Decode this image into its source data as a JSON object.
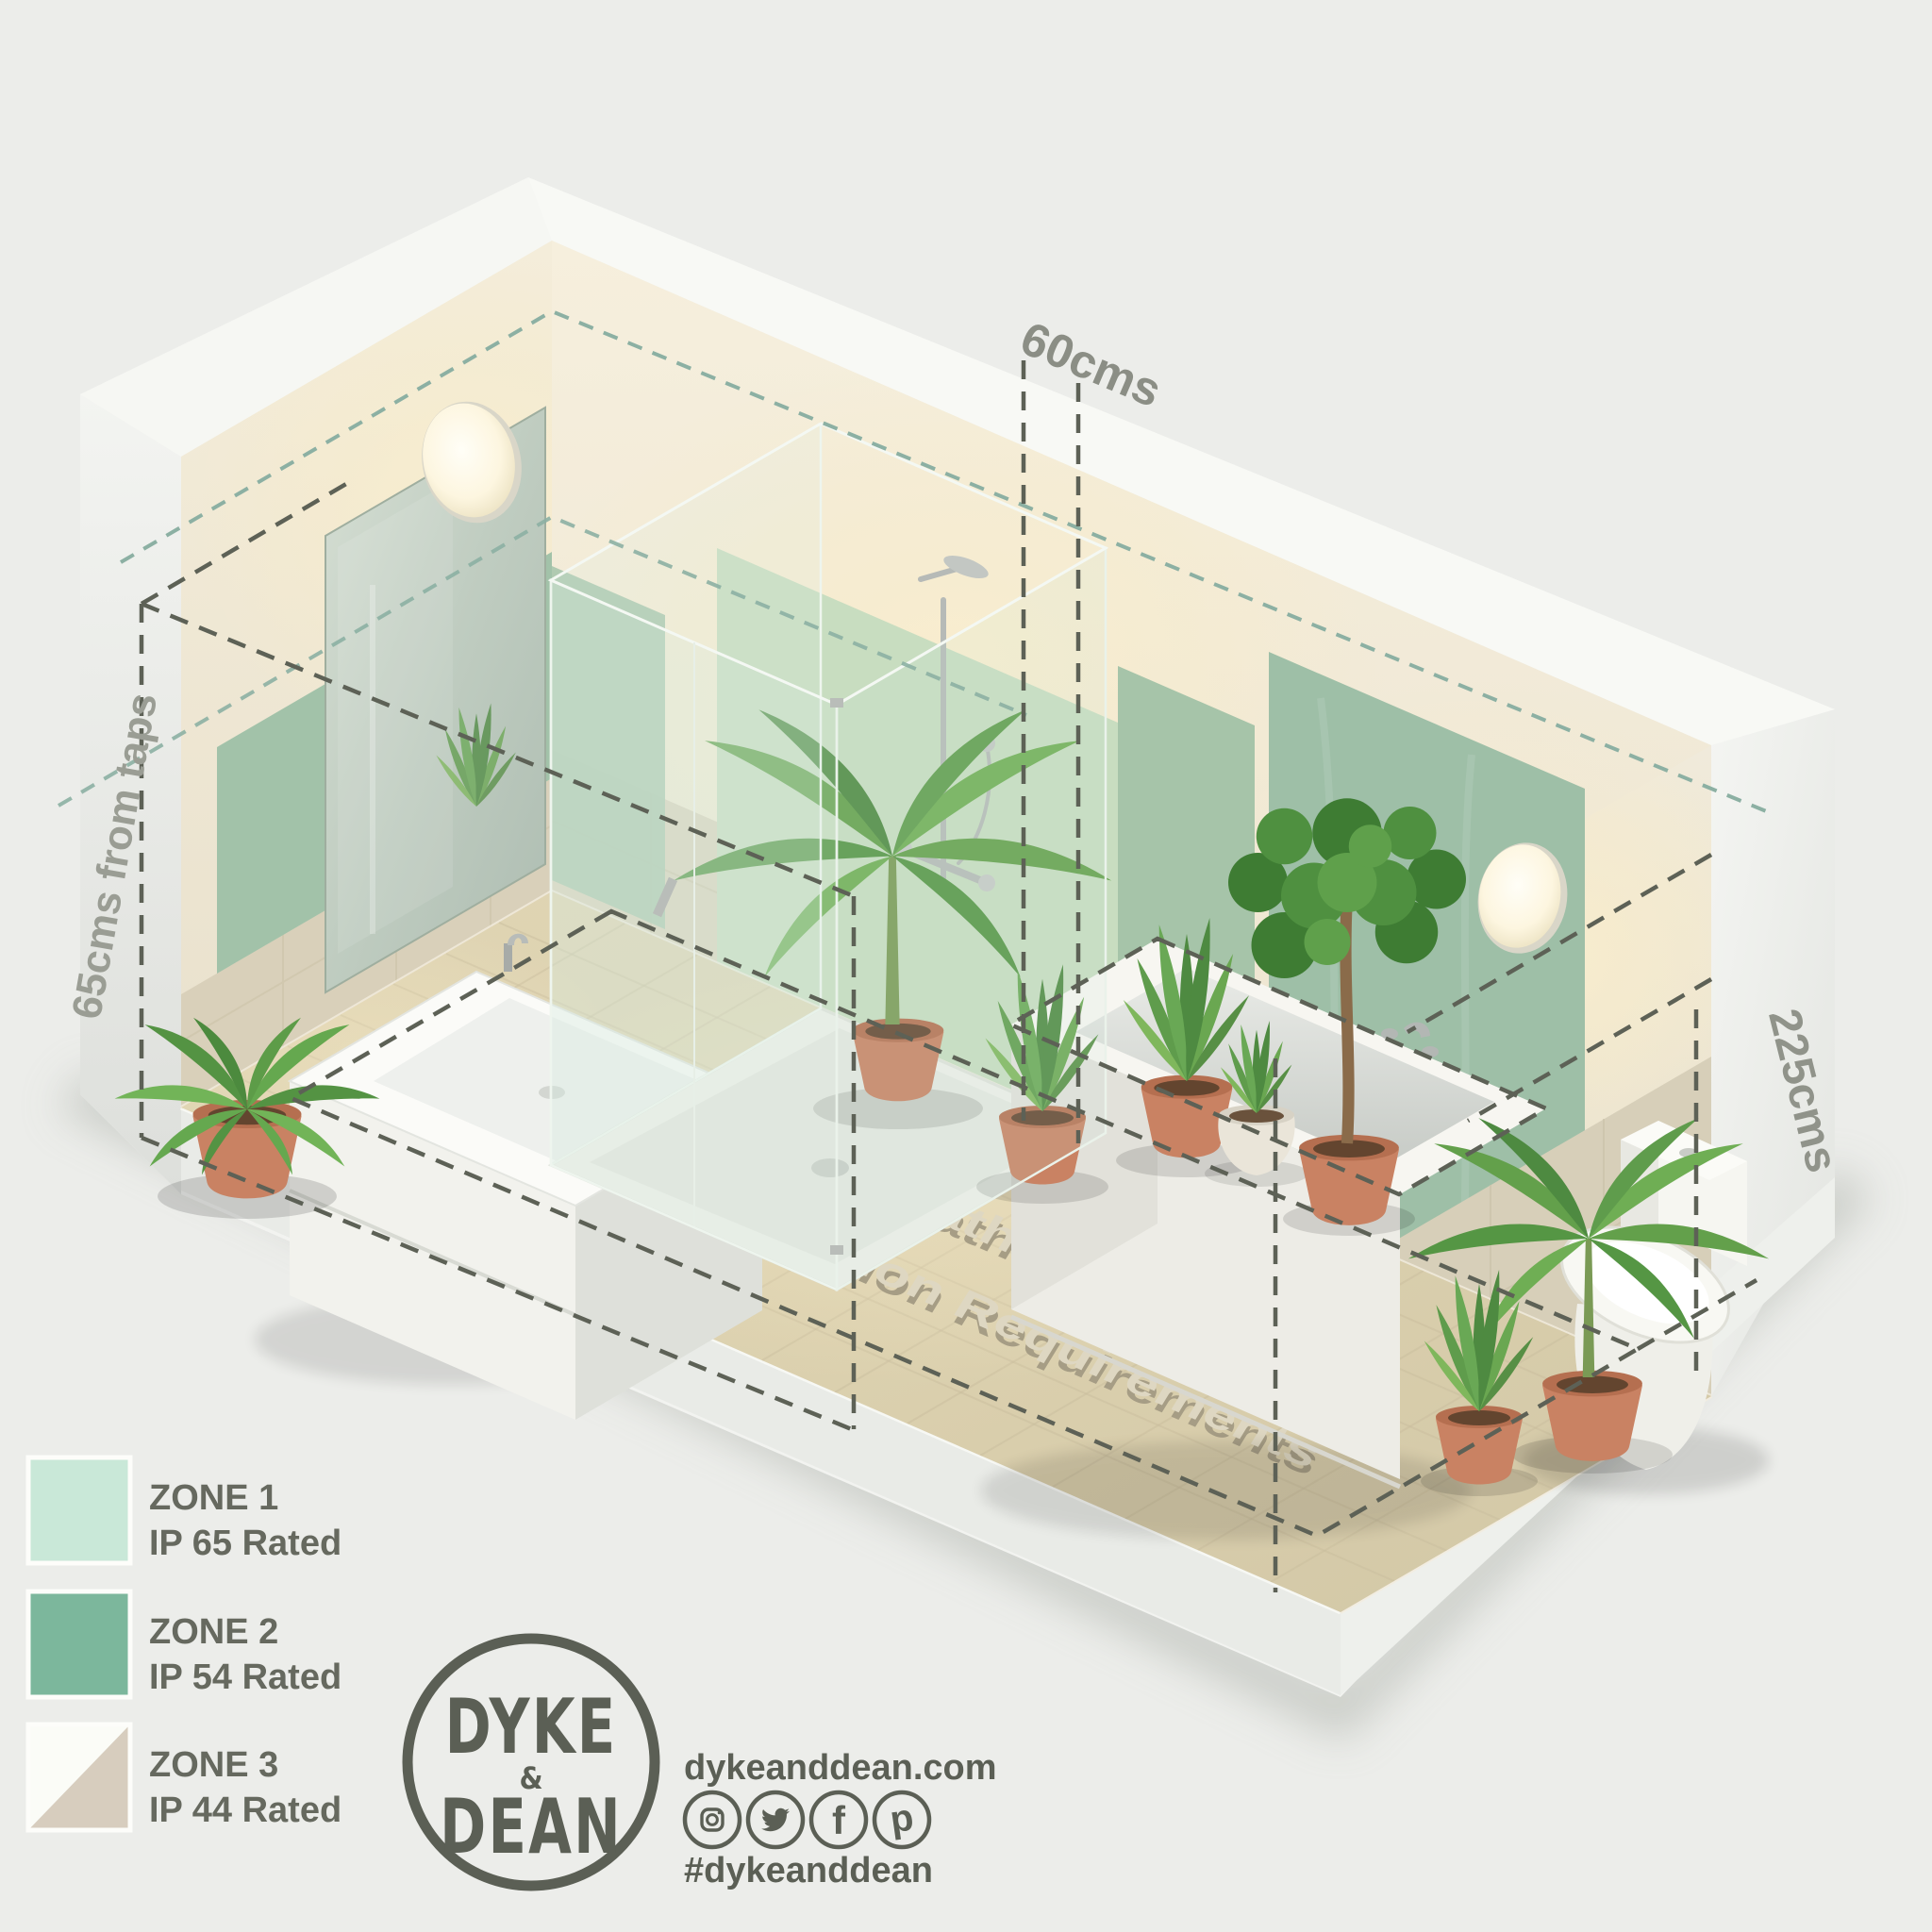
{
  "title_3d": {
    "line1": "IP Rated Bathroom Lighting",
    "line2": "Zone Position Requirements"
  },
  "dimensions": {
    "top": "60cms",
    "left": "65cms from taps",
    "right": "225cms"
  },
  "legend": {
    "items": [
      {
        "zone": "ZONE 1",
        "rating": "IP 65 Rated",
        "color": "#c9e8d8"
      },
      {
        "zone": "ZONE 2",
        "rating": "IP 54 Rated",
        "color": "#7cb79c"
      },
      {
        "zone": "ZONE 3",
        "rating": "IP 44 Rated",
        "color": "#fbfcf7",
        "color2": "#d7cdbe"
      }
    ]
  },
  "branding": {
    "logo_top": "DYKE",
    "logo_amp": "&",
    "logo_bottom": "DEAN",
    "website": "dykeanddean.com",
    "hashtag": "#dykeanddean",
    "fb_glyph": "f",
    "pin_glyph": "p"
  },
  "colors": {
    "background": "#ecedea",
    "brand_gray": "#5b5f55",
    "legend_text": "#66695f",
    "zone1_wall": "#c8ddc0",
    "zone2_wall": "#9ebfa7",
    "zone2_wall_left": "#a2c2a9",
    "dim_text": "#8b8e85"
  }
}
